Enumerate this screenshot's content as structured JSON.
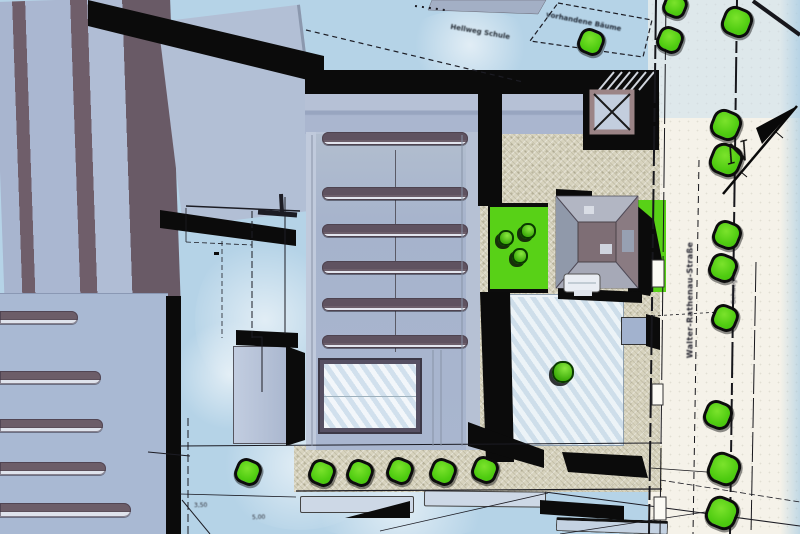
{
  "plan": {
    "street_label": "Walter-Rathenau-Straße",
    "sidewalk_label": "Gehweg",
    "north_label": "N",
    "annotation_dashed_area": "vorhandene Bäume",
    "annotation_upper_left": "Hellweg Schule",
    "dim_note_bottom": "5,00",
    "dim_note_left": "3,50"
  },
  "icons": {
    "north_arrow": "north-arrow"
  },
  "colors": {
    "background_blue": "#b5d3e7",
    "street_cream": "#f5f2e9",
    "roof_blue_gray": "#a9b6cf",
    "roof_stripe_dark": "#6c5e6a",
    "shadow_black": "#0b0b0b",
    "gravel_beige": "#d7d3be",
    "tree_green": "#55d315",
    "lawn_green": "#58d117",
    "xbox_border": "#9b8486"
  },
  "trees": {
    "top_group": [
      [
        675,
        6,
        12
      ],
      [
        737,
        22,
        15
      ],
      [
        591,
        42,
        13
      ],
      [
        670,
        40,
        13
      ]
    ],
    "street_column": [
      [
        726,
        125,
        15
      ],
      [
        726,
        160,
        16
      ],
      [
        727,
        235,
        14
      ],
      [
        723,
        268,
        14
      ],
      [
        725,
        318,
        13
      ],
      [
        718,
        415,
        14
      ],
      [
        724,
        469,
        16
      ],
      [
        722,
        513,
        16
      ]
    ],
    "bottom_row": [
      [
        248,
        472,
        13
      ],
      [
        322,
        473,
        13
      ],
      [
        360,
        473,
        13
      ],
      [
        400,
        471,
        13
      ],
      [
        443,
        472,
        13
      ],
      [
        485,
        470,
        13
      ]
    ]
  },
  "bushes": [
    [
      506,
      238,
      8
    ],
    [
      528,
      231,
      8
    ],
    [
      520,
      256,
      8
    ],
    [
      563,
      372,
      11
    ]
  ]
}
